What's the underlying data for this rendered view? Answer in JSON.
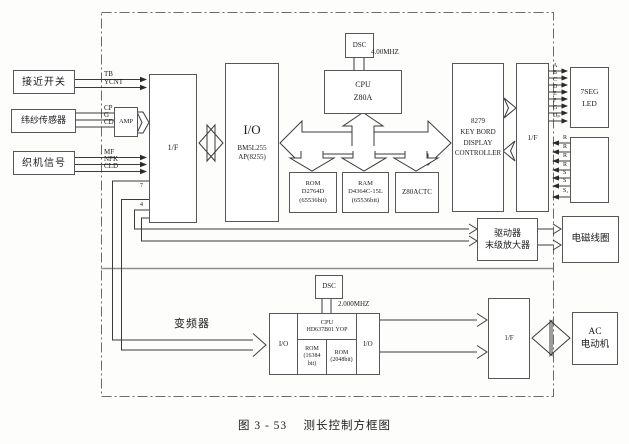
{
  "caption": "图 3 - 53　 测长控制方框图",
  "sources": {
    "proximity": "接近开关",
    "weft": "纬纱传感器",
    "loom": "织机信号"
  },
  "signals": {
    "tb": "TB",
    "ycnt": "YCNT",
    "cp": "CP",
    "g": "G",
    "cd": "CD",
    "mf": "MF",
    "npk": "NPK",
    "cld": "CLD",
    "n7": "7",
    "n4": "4",
    "seg": [
      "A",
      "B",
      "C",
      "D",
      "E",
      "F",
      "G",
      "Dₚ"
    ],
    "key": [
      "R",
      "R",
      "R",
      "R",
      "S",
      "S",
      "S₁"
    ]
  },
  "blocks": {
    "amp": "AMP",
    "if_left": "1/F",
    "io": {
      "t": "I/O",
      "l2": "BM5L255",
      "l3": "AP(8255)"
    },
    "dsc1": "DSC",
    "clk1": "4.00MHZ",
    "cpu1": {
      "l1": "CPU",
      "l2": "Z80A"
    },
    "rom": {
      "l1": "ROM",
      "l2": "D2764D",
      "l3": "(65536bit)"
    },
    "ram": {
      "l1": "RAM",
      "l2": "D4364C-15L",
      "l3": "(65536bit)"
    },
    "ctc": "Z80ACTC",
    "kdc": {
      "l1": "8279",
      "l2": "KEY BORD",
      "l3": "DISPLAY",
      "l4": "CONTROLLER"
    },
    "if_right": "1/F",
    "led": {
      "l1": "7SEG",
      "l2": "LED"
    },
    "driver": {
      "l1": "驱动器",
      "l2": "末级放大器"
    },
    "coil": "电磁线圈",
    "inverter": "变频器",
    "dsc2": "DSC",
    "clk2": "2.000MHZ",
    "mcu": {
      "io1": "I/O",
      "cpu": "CPU",
      "model": "HD637B01 YOP",
      "rom1l1": "ROM",
      "rom1l2": "(16384",
      "rom1l3": "bit)",
      "rom2l1": "ROM",
      "rom2l2": "(2048bit)",
      "io2": "I/O"
    },
    "if_bottom": "1/F",
    "ac": {
      "l1": "AC",
      "l2": "电动机"
    }
  }
}
